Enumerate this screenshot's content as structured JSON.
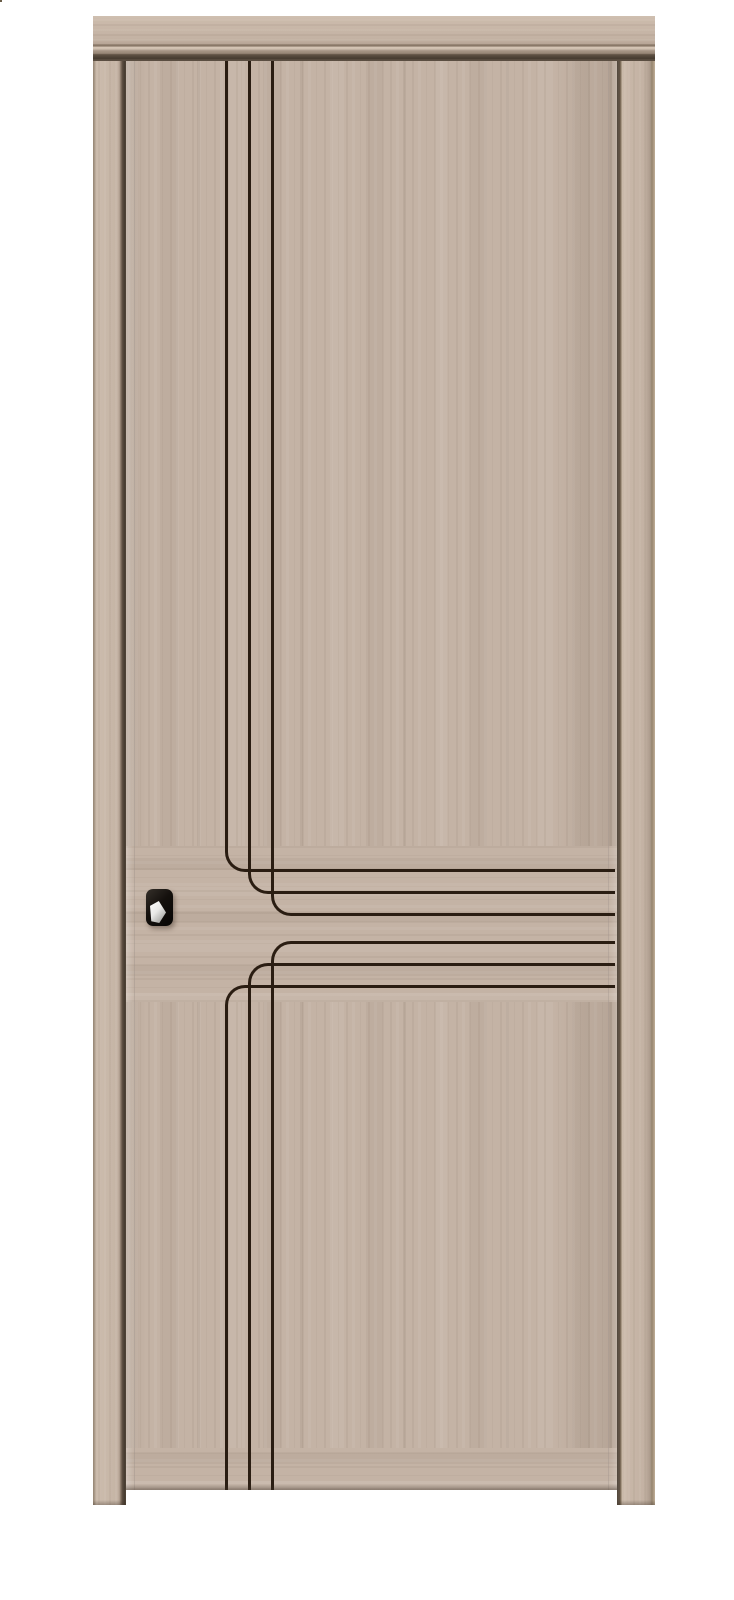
{
  "scene": {
    "description": "Product photo of an interior laminate door with matching frame on a white background",
    "door_finish": "light greige wood grain",
    "decor": "six black inlay grooves: three vertical lines from the top curving right into horizontal lines, and three horizontal lines curving down into vertical lines running to the floor",
    "hardware": "black square-rosette lever handle and black euro-cylinder escutcheon"
  },
  "palette": {
    "bg": "#ffffff",
    "leaf-base": "#c4b3a5",
    "frame-face": "#c9b9ab",
    "frame-dark-gap": "#4f4338",
    "groove": "#2a1d12",
    "hardware-black": "#14100d",
    "cylinder-gold": "#c09a55",
    "highlight-white": "#f6f5f2"
  },
  "layout": {
    "frame-head": {
      "left": 93,
      "top": 16,
      "width": 562,
      "height": 45
    },
    "frame-jamb-left": {
      "left": 93,
      "top": 16,
      "width": 33,
      "height": 1489
    },
    "frame-jamb-right": {
      "left": 617,
      "top": 16,
      "width": 38,
      "height": 1489
    },
    "door-leaf": {
      "left": 126,
      "top": 61,
      "width": 491,
      "height": 1429
    },
    "grain-band-middle": {
      "top": 785,
      "height": 156
    },
    "grain-band-bottom": {
      "top": 1387,
      "height": 42
    },
    "handle-rosette": {
      "left": 146,
      "top": 889,
      "width": 27,
      "height": 37
    },
    "rosette-highlight": {
      "left": 150,
      "top": 901,
      "width": 16,
      "height": 22
    },
    "handle-lever": {
      "left": 164,
      "top": 897,
      "width": 80,
      "height": 26
    },
    "lock-plate": {
      "left": 148,
      "top": 943,
      "width": 35,
      "height": 36
    },
    "lock-inner": {
      "left": 153,
      "top": 948,
      "width": 25,
      "height": 26
    },
    "cylinder-body": {
      "left": 158,
      "top": 954,
      "width": 15,
      "height": 18
    },
    "key-slot": {
      "left": 163,
      "top": 960,
      "width": 5,
      "height": 9
    },
    "cylinder-gold": {
      "left": 160,
      "top": 948,
      "width": 11,
      "height": 11
    }
  },
  "grooves": {
    "thickness": 3,
    "corner_radius": 20,
    "right_end": 489,
    "leaf_height": 1429,
    "top_group": [
      {
        "x": 99,
        "y": 811
      },
      {
        "x": 122,
        "y": 833
      },
      {
        "x": 145,
        "y": 855
      }
    ],
    "bottom_group": [
      {
        "x": 145,
        "y": 880
      },
      {
        "x": 122,
        "y": 902
      },
      {
        "x": 99,
        "y": 924
      }
    ]
  }
}
